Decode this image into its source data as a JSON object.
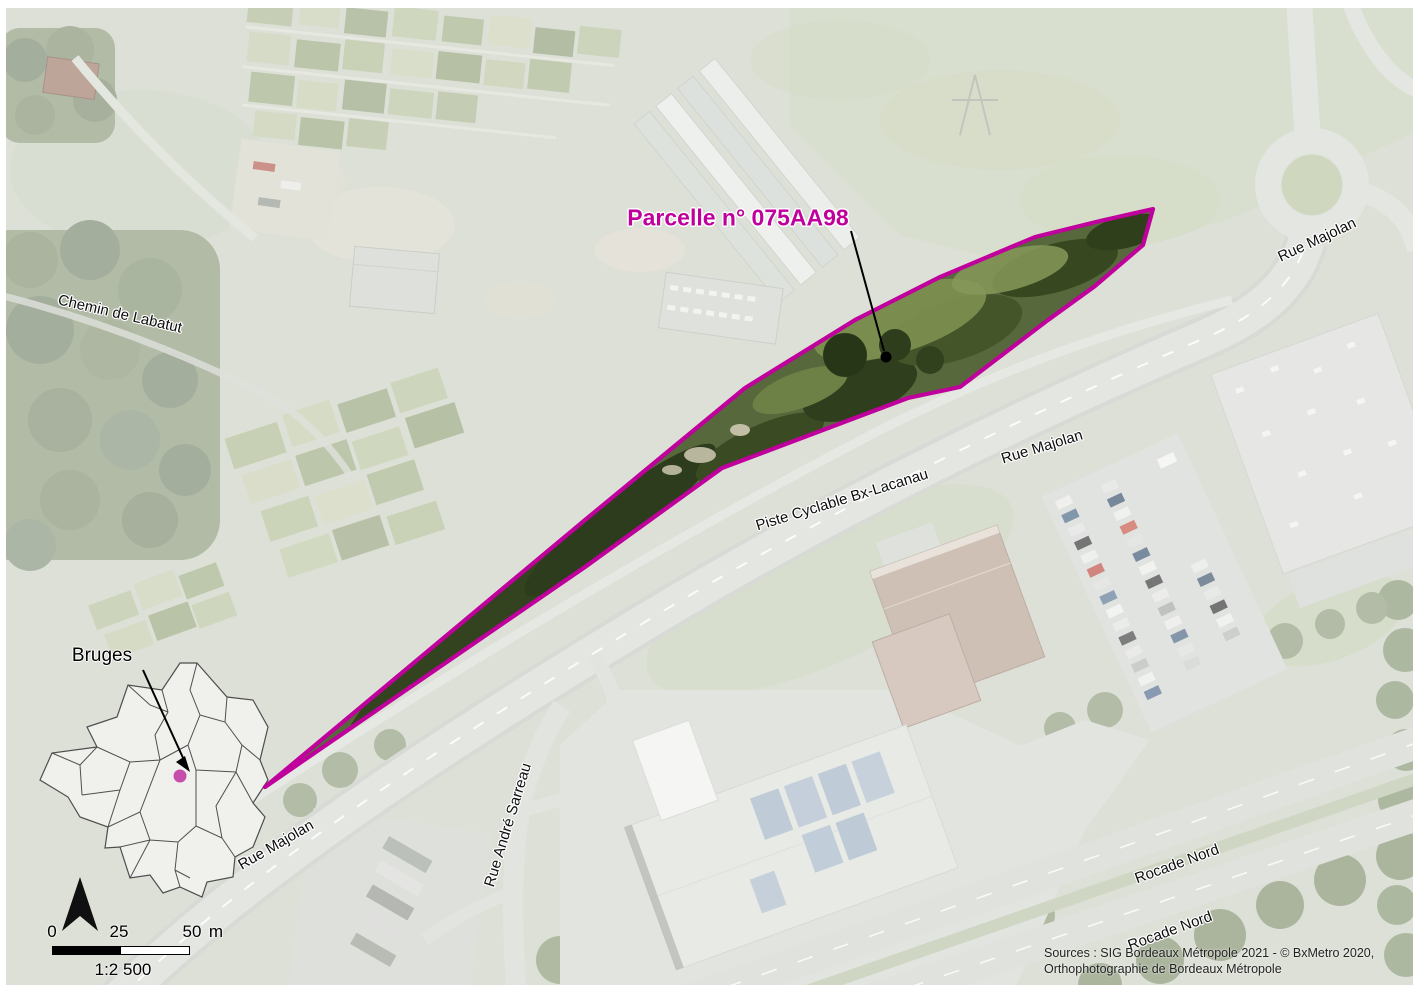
{
  "map": {
    "parcel": {
      "label": "Parcelle n° 075AA98"
    },
    "inset": {
      "label": "Bruges"
    },
    "roads": {
      "chemin_labatut": "Chemin de Labatut",
      "rue_majolan_top": "Rue Majolan",
      "piste_cyclable": "Piste Cyclable Bx-Lacanau",
      "rue_majolan_mid": "Rue Majolan",
      "rue_andre_sarreau": "Rue André Sarreau",
      "rue_majolan_bottom": "Rue Majolan",
      "rocade_nord_1": "Rocade Nord",
      "rocade_nord_2": "Rocade Nord"
    },
    "scalebar": {
      "t0": "0",
      "t25": "25",
      "t50": "50",
      "unit": "m",
      "ratio": "1:2 500"
    },
    "credits": {
      "line1": "Sources : SIG Bordeaux Métropole 2021 - © BxMetro 2020,",
      "line2": "Orthophotographie de Bordeaux Métropole"
    },
    "colors": {
      "parcel_outline": "#c0009c",
      "parcel_marker": "#c13ba3"
    }
  }
}
